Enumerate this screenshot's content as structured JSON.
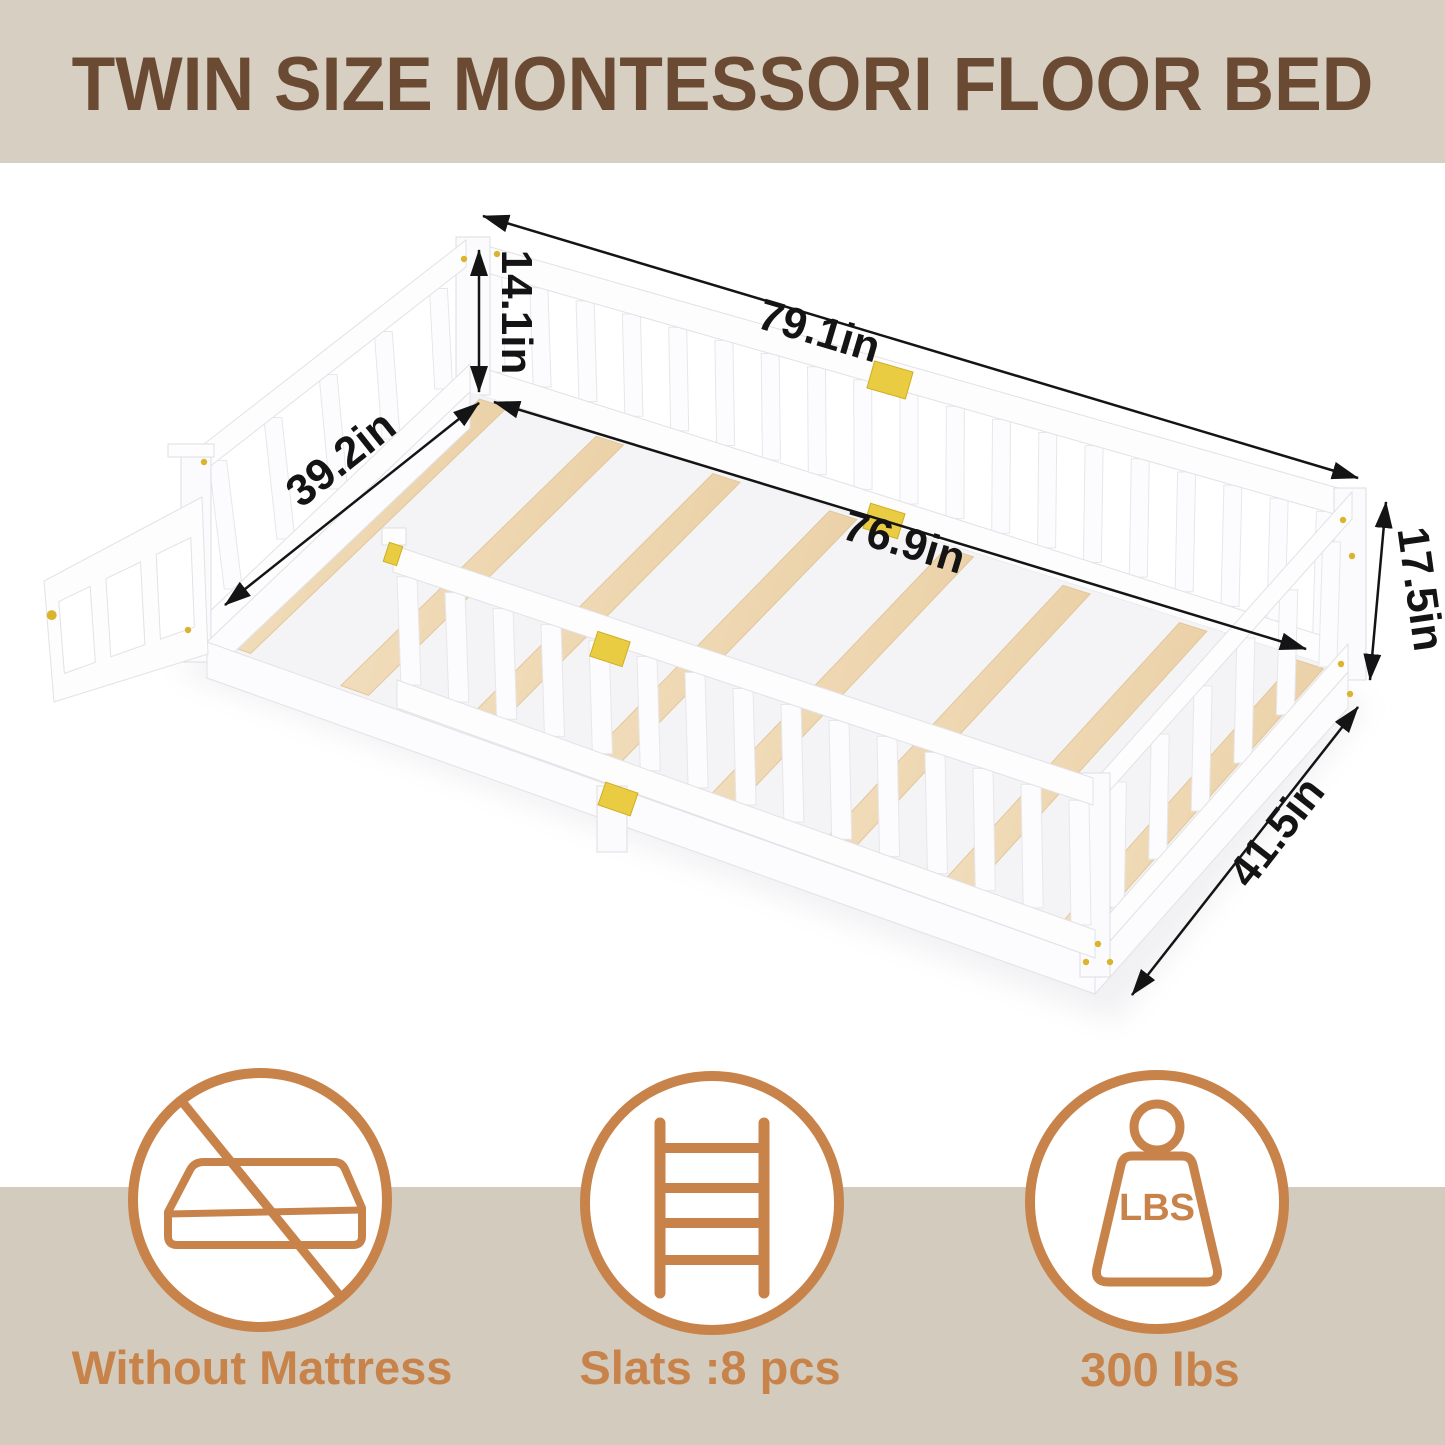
{
  "header": {
    "title": "TWIN SIZE MONTESSORI FLOOR BED",
    "bg_color": "#d7d0c2",
    "text_color": "#6b4a33"
  },
  "diagram": {
    "dimensions": {
      "rail_height": "14.1in",
      "outer_length": "79.1in",
      "inner_width": "39.2in",
      "inner_length": "76.9in",
      "foot_height": "17.5in",
      "outer_width": "41.5in"
    },
    "slat_count": 8,
    "colors": {
      "wood": "#efd8b4",
      "hardware_gold": "#eacc42",
      "frame_white": "#fdfdfe",
      "dimension_ink": "#141414"
    }
  },
  "features": [
    {
      "icon": "no-mattress-icon",
      "label": "Without Mattress"
    },
    {
      "icon": "ladder-icon",
      "label": "Slats :8 pcs"
    },
    {
      "icon": "weight-icon",
      "label": "300 lbs",
      "badge": "LBS"
    }
  ],
  "footer": {
    "bg_color": "#d3ccbe",
    "accent_color": "#c8834b"
  }
}
